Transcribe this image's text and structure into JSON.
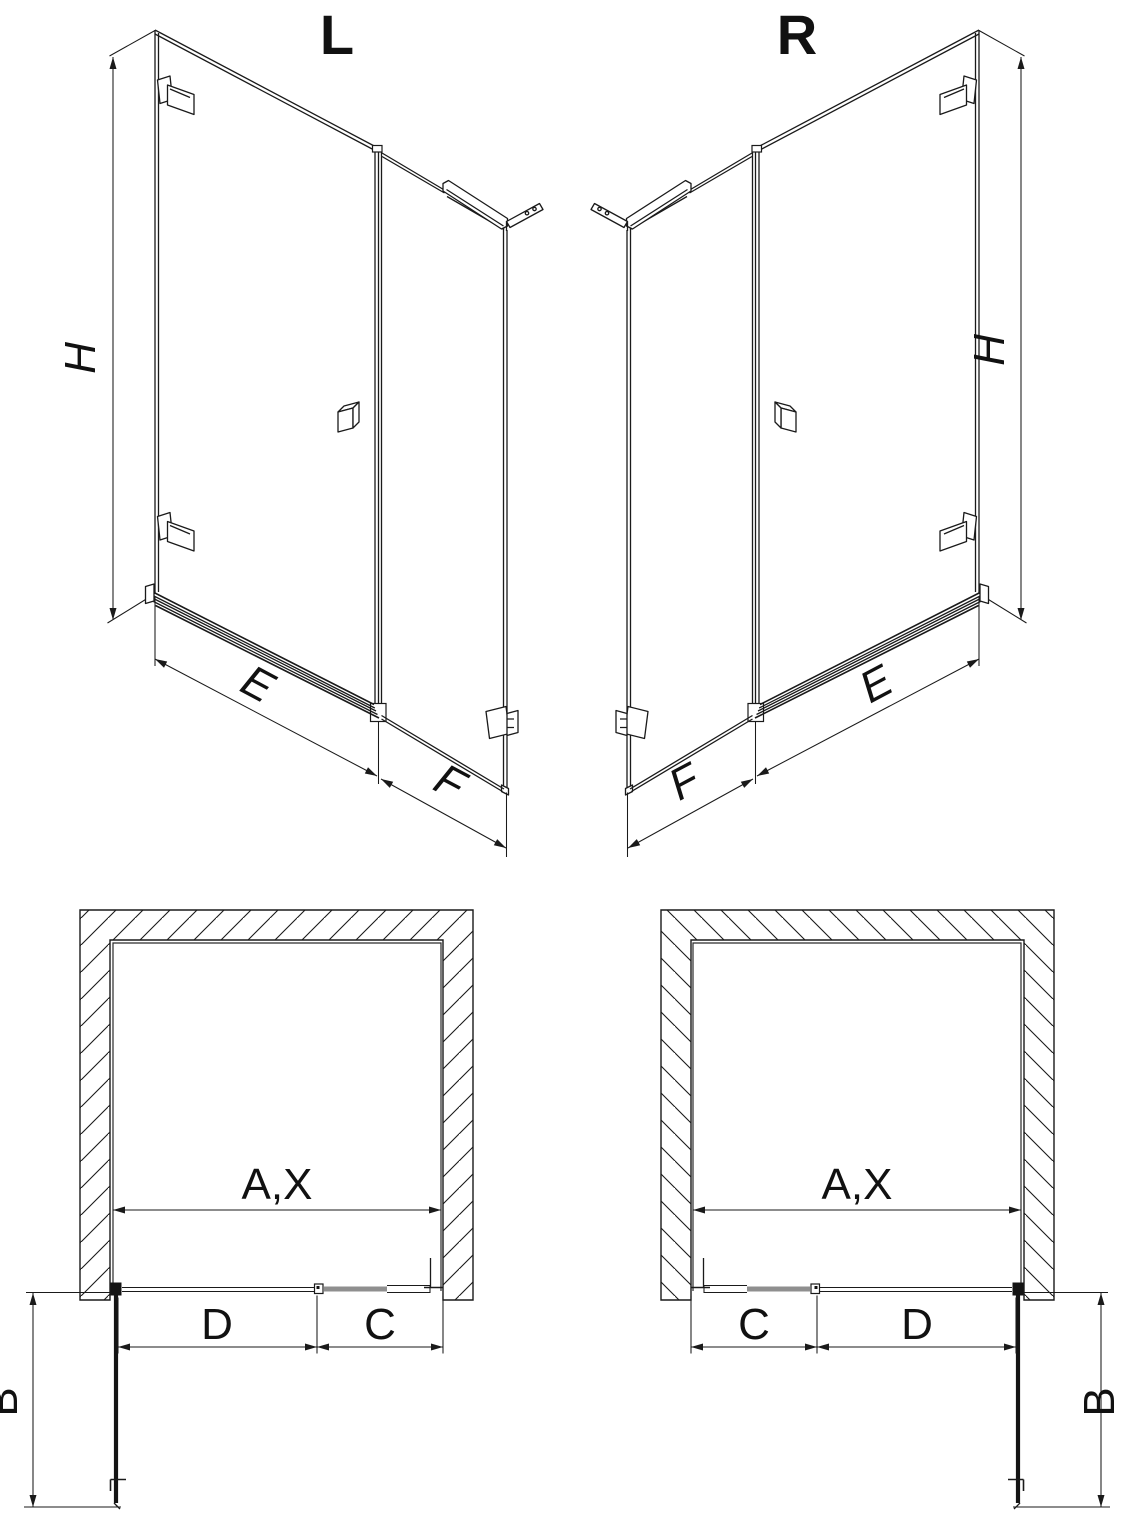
{
  "figures": {
    "iso_left": {
      "title": "L",
      "dims": {
        "height": "H",
        "door_width": "E",
        "panel_width": "F"
      }
    },
    "iso_right": {
      "title": "R",
      "dims": {
        "height": "H",
        "door_width": "E",
        "panel_width": "F"
      }
    },
    "plan_left": {
      "dims": {
        "opening": "A,X",
        "door": "D",
        "fixed_panel": "C",
        "door_open_depth": "B"
      }
    },
    "plan_right": {
      "dims": {
        "opening": "A,X",
        "door": "D",
        "fixed_panel": "C",
        "door_open_depth": "B"
      }
    }
  },
  "colors": {
    "line": "#1a1a1a",
    "glass_gray": "#8f8f8f",
    "background": "#ffffff"
  }
}
